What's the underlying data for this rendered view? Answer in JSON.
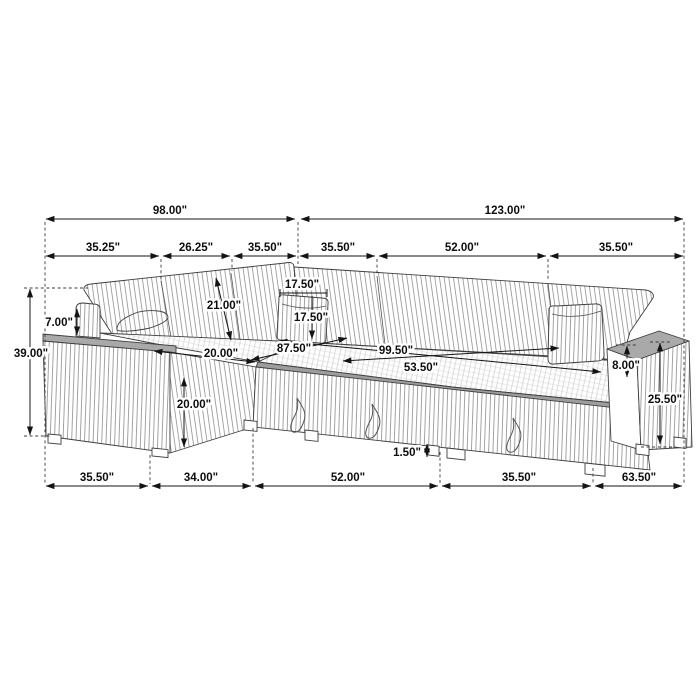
{
  "diagram": {
    "subject": "sectional-sleeper-sofa-dimension-drawing",
    "units": "inches",
    "colors": {
      "background": "#ffffff",
      "line_art": "#3f3f3f",
      "dimension_lines": "#141414",
      "top_surface_gray": "#a9a9a9",
      "front_band_gray": "#9d9d9d"
    },
    "dimensions": {
      "overall_top": [
        "98.00\"",
        "123.00\""
      ],
      "sections_top": [
        "35.25\"",
        "26.25\"",
        "35.50\"",
        "35.50\"",
        "52.00\"",
        "35.50\""
      ],
      "left_height": "39.00\"",
      "arm_height_left": "7.00\"",
      "back_height": "21.00\"",
      "pillow_width": "17.50\"",
      "pillow_height": "17.50\"",
      "chaise_width": "20.00\"",
      "chaise_depth": "20.00\"",
      "bed_width": "87.50\"",
      "bed_length": "99.50\"",
      "bed_depth": "53.50\"",
      "arm_height_right": "8.00\"",
      "side_height_right": "25.50\"",
      "leg_height": "1.50\"",
      "sections_bottom": [
        "35.50\"",
        "34.00\"",
        "52.00\"",
        "35.50\"",
        "63.50\""
      ]
    }
  }
}
